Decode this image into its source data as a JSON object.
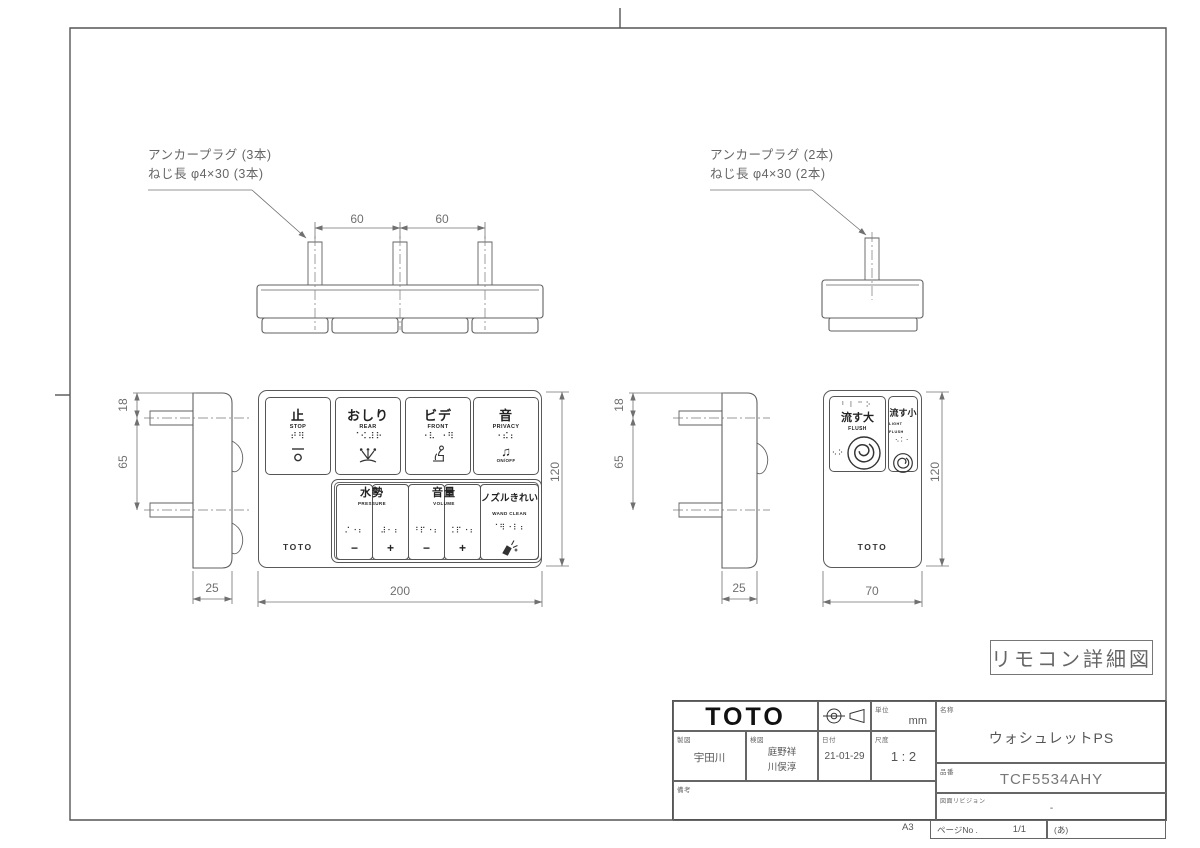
{
  "page": {
    "label_box": "リモコン詳細図",
    "sheet_size": "A3"
  },
  "colors": {
    "line": "#606060",
    "dim_line": "#707070",
    "ink": "#222222",
    "background": "#ffffff"
  },
  "annotations": {
    "left": {
      "line1": "アンカープラグ (3本)",
      "line2": "ねじ長 φ4×30 (3本)"
    },
    "right": {
      "line1": "アンカープラグ (2本)",
      "line2": "ねじ長 φ4×30 (2本)"
    }
  },
  "dimensions": {
    "screw_pitch_left": "60",
    "screw_pitch_right": "60",
    "left_side": {
      "top_offset": "18",
      "pin_pitch": "65",
      "depth": "25"
    },
    "right_side": {
      "top_offset": "18",
      "pin_pitch": "65",
      "depth": "25"
    },
    "main": {
      "width": "200",
      "height": "120"
    },
    "flush": {
      "width": "70",
      "height": "120"
    }
  },
  "main_remote": {
    "brand": "TOTO",
    "buttons_top": [
      {
        "kanji": "止",
        "en": "STOP",
        "braille": "⠞⠻"
      },
      {
        "kanji": "おしり",
        "en": "REAR",
        "braille": "⠈⠪⠼⠗"
      },
      {
        "kanji": "ビデ",
        "en": "FRONT",
        "braille": "⠐⠧ ⠐⠻"
      },
      {
        "kanji": "音",
        "en": "PRIVACY",
        "braille": "⠐⠮⠆",
        "icon_glyph": "♫",
        "icon_caption": "ON/OFF"
      }
    ],
    "groups_bottom": [
      {
        "kanji": "水勢",
        "en": "PRESSURE",
        "minus": "−",
        "plus": "+",
        "minus_braille": "⠌⠐⠆",
        "plus_braille": "⠼⠂⠆"
      },
      {
        "kanji": "音量",
        "en": "VOLUME",
        "minus": "−",
        "plus": "+",
        "minus_braille": "⠘⠏⠐⠆",
        "plus_braille": "⠨⠏⠐⠆"
      },
      {
        "kanji": "ノズルきれい",
        "en": "WAND CLEAN",
        "braille": "⠈⠻⠐⠇⠆"
      }
    ]
  },
  "flush_remote": {
    "brand": "TOTO",
    "large": {
      "kanji": "流す大",
      "en": "FLUSH",
      "braille_top": "⠃⠇⠉⠕",
      "braille_side": "⠢⠕"
    },
    "small": {
      "kanji": "流す小",
      "en": "LIGHT FLUSH",
      "braille": "⠢⠅⠂"
    }
  },
  "title_block": {
    "brand": "TOTO",
    "unit_label": "単位",
    "unit": "mm",
    "drafter_label": "製図",
    "drafter": "宇田川",
    "checker_label": "検図",
    "checker_1": "庭野祥",
    "checker_2": "川俣淳",
    "date_label": "日付",
    "date": "21-01-29",
    "scale_label": "尺度",
    "scale": "1 : 2",
    "remarks_label": "備考",
    "name_label": "名称",
    "product_name": "ウォシュレットPS",
    "part_label": "品番",
    "part_number": "TCF5534AHY",
    "revision_label": "図面リビジョン",
    "revision": "-",
    "page_label": "ページNo .",
    "page": "1/1",
    "page_note": "(あ)",
    "sheet_size": "A3"
  }
}
